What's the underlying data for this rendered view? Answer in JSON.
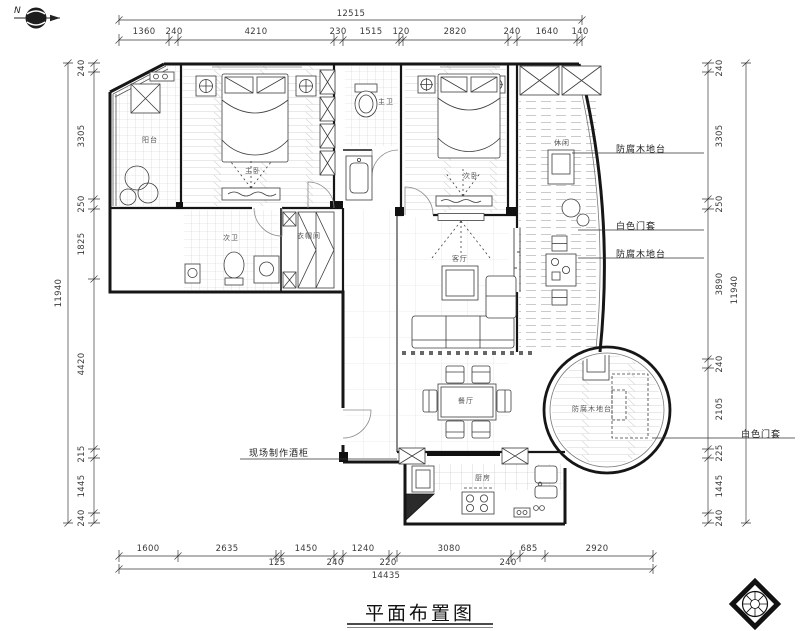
{
  "title": {
    "text": "平面布置图"
  },
  "compass": {
    "label": "N"
  },
  "dimensions": {
    "top": {
      "total": "12515",
      "segments": [
        "1360",
        "240",
        "4210",
        "230",
        "1515",
        "120",
        "2820",
        "240",
        "1640",
        "140"
      ]
    },
    "left": {
      "total": "11940",
      "segments": [
        "240",
        "3305",
        "250",
        "1825",
        "4420",
        "215",
        "1445",
        "240"
      ]
    },
    "right": {
      "total": "11940",
      "segments": [
        "240",
        "3305",
        "250",
        "3890",
        "240",
        "2105",
        "225",
        "1445",
        "240"
      ]
    },
    "bottom": {
      "total": "14435",
      "segments_row1": [
        "1600",
        "2635",
        "1450",
        "1240",
        "3080",
        "685",
        "2920"
      ],
      "segments_row2": [
        "125",
        "240",
        "220",
        "240"
      ]
    }
  },
  "annotations": {
    "deck_platform_1": "防腐木地台",
    "door_casing_1": "白色门套",
    "deck_platform_2": "防腐木地台",
    "door_casing_2": "白色门套",
    "wine_cabinet": "现场制作酒柜"
  },
  "rooms": {
    "balcony": "阳台",
    "master_bedroom": "主卧",
    "master_bath": "主卫",
    "second_bedroom": "次卧",
    "leisure_deck": "休闲",
    "second_bath": "次卫",
    "cloakroom": "衣帽间",
    "living_room": "客厅",
    "dining_room": "餐厅",
    "kitchen": "厨房",
    "round_platform": "防腐木地台"
  },
  "colors": {
    "line": "#1a1a1a",
    "light_line": "#c9c9c9",
    "text": "#3a3a3a"
  }
}
